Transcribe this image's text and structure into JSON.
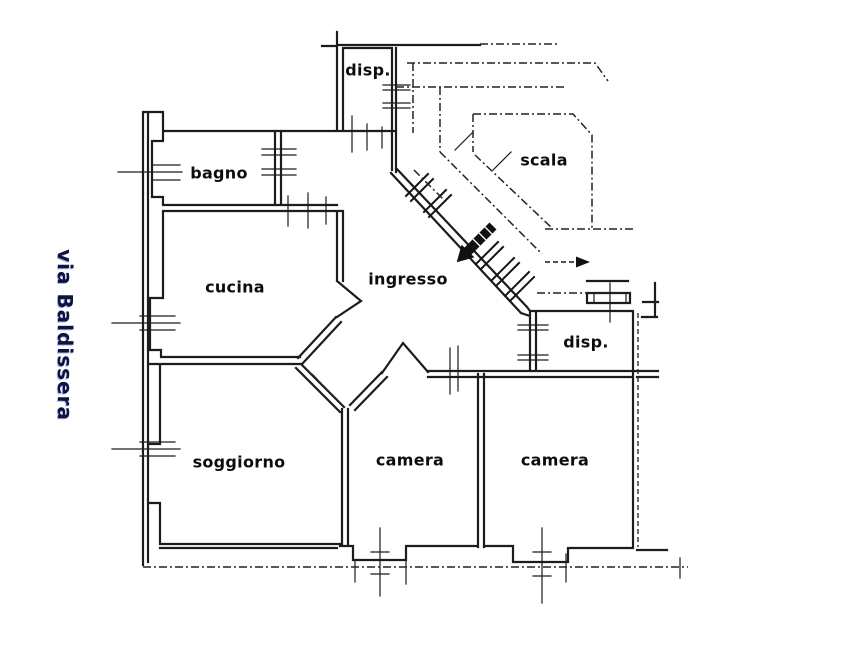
{
  "page": {
    "type": "scanned floor plan",
    "paper_color": "#ffffff",
    "ink_color": "#1c1c1c",
    "street_text_color": "#10123f"
  },
  "street": {
    "label": "via Baldissera"
  },
  "rooms": [
    {
      "id": "disp-top",
      "label": "disp."
    },
    {
      "id": "bagno",
      "label": "bagno"
    },
    {
      "id": "scala",
      "label": "scala"
    },
    {
      "id": "cucina",
      "label": "cucina"
    },
    {
      "id": "ingresso",
      "label": "ingresso"
    },
    {
      "id": "disp-right",
      "label": "disp."
    },
    {
      "id": "soggiorno",
      "label": "soggiorno"
    },
    {
      "id": "camera-1",
      "label": "camera"
    },
    {
      "id": "camera-2",
      "label": "camera"
    }
  ],
  "icons": {
    "stairs_direction_arrow": "filled-arrow-down-left",
    "stairs_up_arrow": "dashed-arrow-right"
  }
}
